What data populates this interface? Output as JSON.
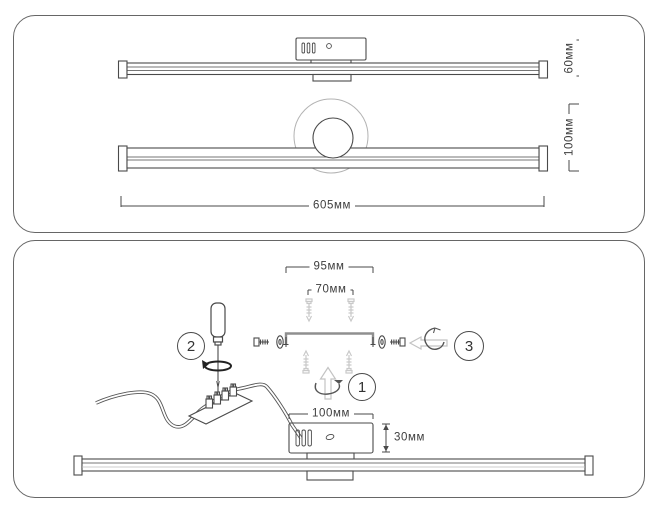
{
  "colors": {
    "background": "#ffffff",
    "panel_border": "#666666",
    "line_dark": "#4a4a4a",
    "line_mid": "#8f8f8f",
    "line_light": "#c7c7c7",
    "text": "#3d3d3d"
  },
  "top_panel": {
    "dimensions": {
      "side_height": "60мм",
      "front_height": "100мм",
      "length": "605мм"
    }
  },
  "bottom_panel": {
    "dimensions": {
      "bracket_width": "95мм",
      "hole_spacing": "70мм",
      "canopy_width": "100мм",
      "canopy_height": "30мм"
    },
    "steps": {
      "step1": "1",
      "step2": "2",
      "step3": "3"
    }
  }
}
